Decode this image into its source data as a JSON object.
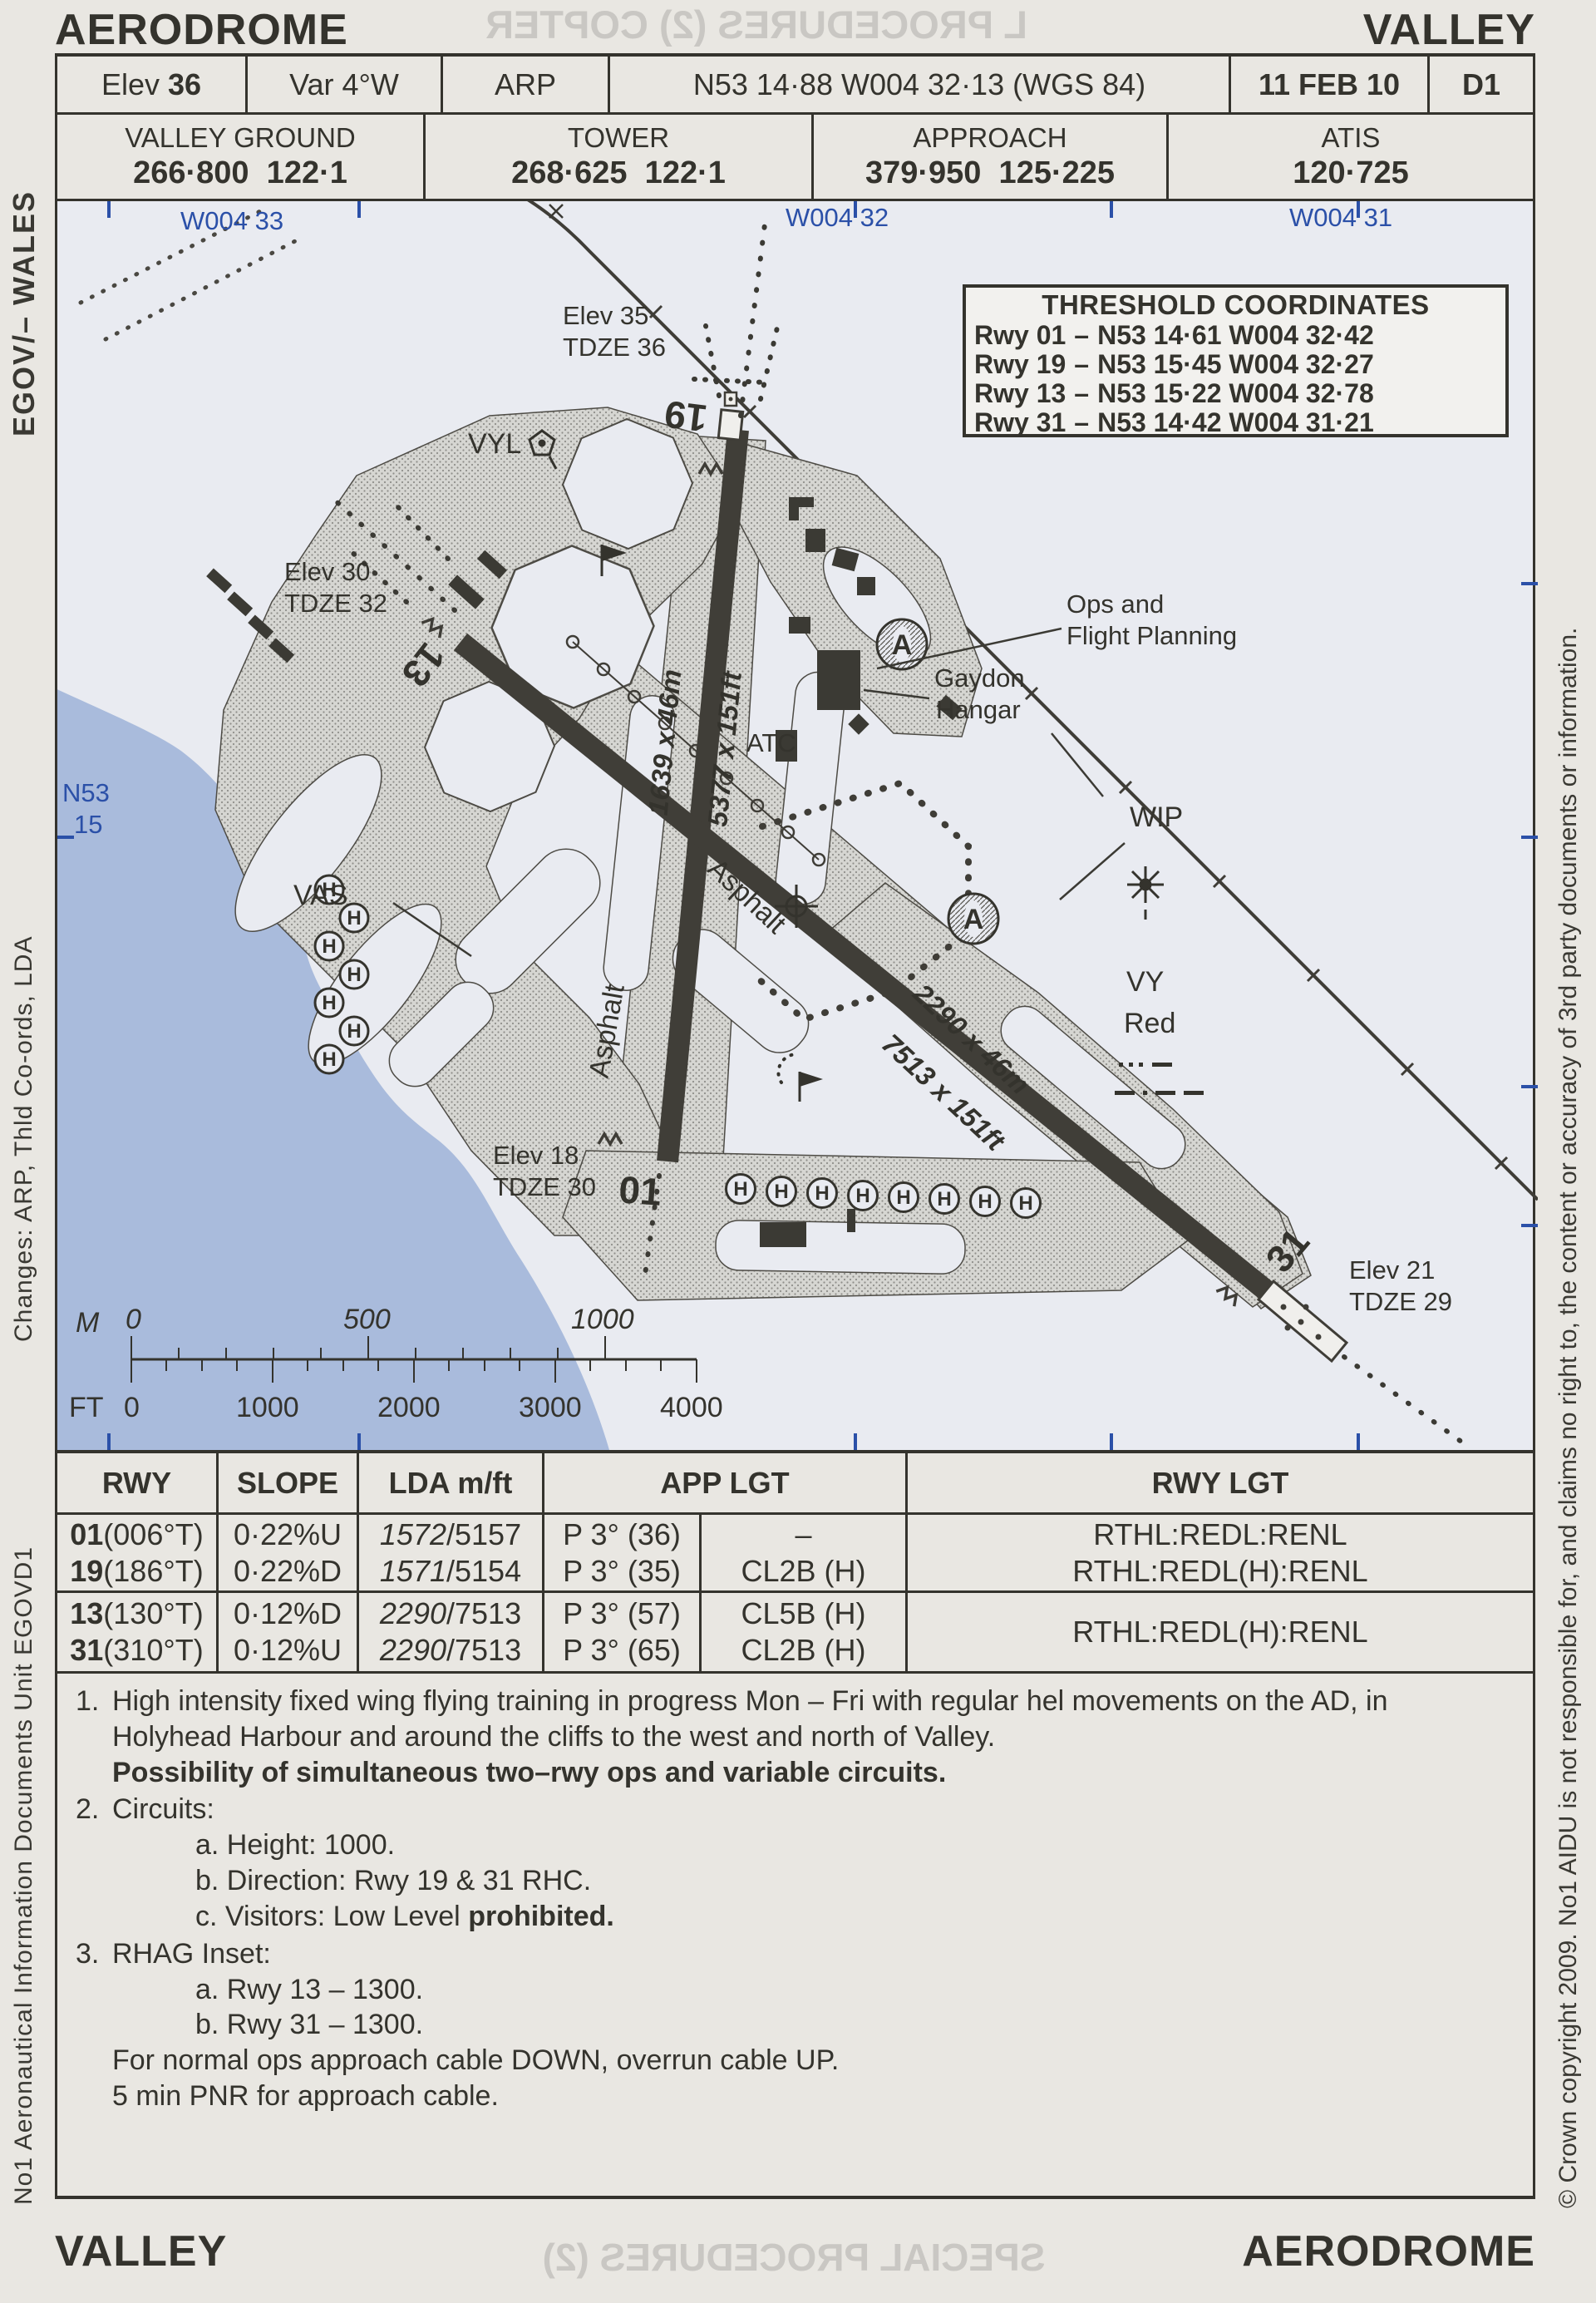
{
  "page": {
    "title_left": "AERODROME",
    "title_right": "VALLEY",
    "footer_left": "VALLEY",
    "footer_right": "AERODROME"
  },
  "header": {
    "elev_label": "Elev",
    "elev_value": "36",
    "variation": "Var 4°W",
    "arp_label": "ARP",
    "arp_coords": "N53 14·88 W004 32·13 (WGS 84)",
    "date": "11 FEB 10",
    "sheet": "D1"
  },
  "frequencies": [
    {
      "name": "VALLEY GROUND",
      "value": "266·800  122·1"
    },
    {
      "name": "TOWER",
      "value": "268·625  122·1"
    },
    {
      "name": "APPROACH",
      "value": "379·950  125·225"
    },
    {
      "name": "ATIS",
      "value": "120·725"
    }
  ],
  "sidebars": {
    "left_top": "EGOV/– WALES",
    "left_middle": "Changes: ARP, Thld Co-ords, LDA",
    "left_bottom": "No1 Aeronautical Information Documents Unit EGOVD1",
    "right": "© Crown copyright 2009. No1 AIDU is not responsible for, and claims no right to, the content or accuracy of 3rd party documents or information."
  },
  "map": {
    "graticule": {
      "lon_0": "W004 33",
      "lon_1": "W004 32",
      "lon_2": "W004 31",
      "lat_line1": "N53",
      "lat_line2": "15"
    },
    "threshold_box": {
      "title": "THRESHOLD COORDINATES",
      "rows": [
        {
          "rwy": "Rwy 01",
          "sep": "–",
          "coords": "N53 14·61 W004 32·42"
        },
        {
          "rwy": "Rwy 19",
          "sep": "–",
          "coords": "N53 15·45 W004 32·27"
        },
        {
          "rwy": "Rwy 13",
          "sep": "–",
          "coords": "N53 15·22 W004 32·78"
        },
        {
          "rwy": "Rwy 31",
          "sep": "–",
          "coords": "N53 14·42 W004 31·21"
        }
      ]
    },
    "labels": {
      "elev35": "Elev 35",
      "tdze36": "TDZE 36",
      "elev30": "Elev 30",
      "tdze32": "TDZE 32",
      "elev18": "Elev 18",
      "tdze30": "TDZE 30",
      "elev21": "Elev 21",
      "tdze29": "TDZE 29",
      "rwy19": "19",
      "rwy01": "01",
      "rwy13": "13",
      "rwy31": "31",
      "dim_0119_m": "1639 x 46m",
      "dim_0119_ft": "5377 x 151ft",
      "dim_1331_m": "2290 x 46m",
      "dim_1331_ft": "7513 x 151ft",
      "asphalt": "Asphalt",
      "atc": "ATC",
      "vyl": "VYL",
      "vas": "VAS",
      "wip": "WIP",
      "ops1": "Ops and",
      "ops2": "Flight Planning",
      "gaydon1": "Gaydon",
      "gaydon2": "Hangar",
      "vy": "VY",
      "red": "Red",
      "helipad": "H",
      "dispersal": "A"
    },
    "scale": {
      "m_label": "M",
      "m_ticks": [
        "0",
        "500",
        "1000"
      ],
      "ft_label": "FT",
      "ft_ticks": [
        "0",
        "1000",
        "2000",
        "3000",
        "4000"
      ]
    }
  },
  "runway_table": {
    "headers": {
      "rwy": "RWY",
      "slope": "SLOPE",
      "lda": "LDA m/ft",
      "app": "APP LGT",
      "rwy_lgt": "RWY LGT"
    },
    "groups": [
      {
        "rows": [
          {
            "num": "01",
            "brg": "(006°T)",
            "slope": "0·22%U",
            "lda_m": "1572",
            "lda_ft": "/5157",
            "papi": "P 3° (36)",
            "cl": "–"
          },
          {
            "num": "19",
            "brg": "(186°T)",
            "slope": "0·22%D",
            "lda_m": "1571",
            "lda_ft": "/5154",
            "papi": "P 3° (35)",
            "cl": "CL2B (H)"
          }
        ],
        "rwy_lgt_1": "RTHL:REDL:RENL",
        "rwy_lgt_2": "RTHL:REDL(H):RENL"
      },
      {
        "rows": [
          {
            "num": "13",
            "brg": "(130°T)",
            "slope": "0·12%D",
            "lda_m": "2290",
            "lda_ft": "/7513",
            "papi": "P 3° (57)",
            "cl": "CL5B (H)"
          },
          {
            "num": "31",
            "brg": "(310°T)",
            "slope": "0·12%U",
            "lda_m": "2290",
            "lda_ft": "/7513",
            "papi": "P 3° (65)",
            "cl": "CL2B (H)"
          }
        ],
        "rwy_lgt_1": "RTHL:REDL(H):RENL"
      }
    ]
  },
  "notes": {
    "n1_num": "1.",
    "n1_text": "High intensity fixed wing flying training in progress Mon – Fri with regular hel movements on the AD, in Holyhead Harbour and around the cliffs to the west and north of Valley.",
    "n1_bold": "Possibility of simultaneous two–rwy ops and variable circuits.",
    "n2_num": "2.",
    "n2_text": "Circuits:",
    "n2a": "a. Height: 1000.",
    "n2b": "b. Direction: Rwy 19 & 31 RHC.",
    "n2c_pre": "c. Visitors: Low Level ",
    "n2c_bold": "prohibited.",
    "n3_num": "3.",
    "n3_text": "RHAG Inset:",
    "n3a": "a. Rwy 13 – 1300.",
    "n3b": "b. Rwy 31 – 1300.",
    "n3_tail1": "For normal ops approach cable DOWN, overrun cable UP.",
    "n3_tail2": "5 min PNR for approach cable."
  },
  "ghost_text": {
    "top": "L PROCEDURES (2) COPTER",
    "bottom": "SPECIAL PROCEDURES (2)",
    "map": "Stables"
  }
}
